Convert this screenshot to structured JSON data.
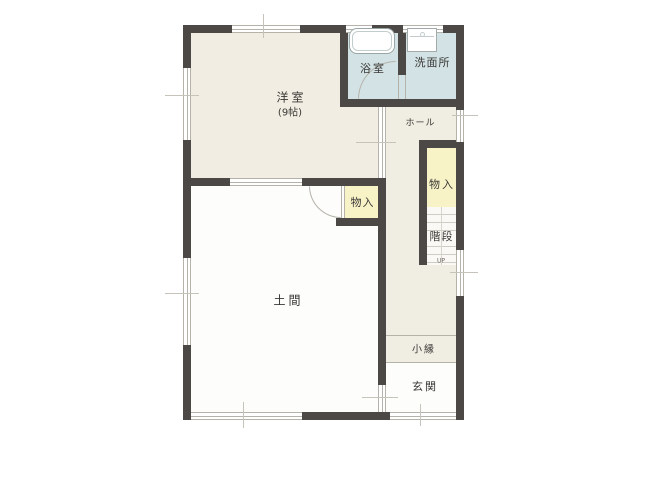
{
  "page_title": "間取り図（1階平面図）",
  "colors": {
    "wall": "#4b4846",
    "beige": "#f1ede2",
    "blue": "#d3e3e5",
    "cream": "#f0ede2",
    "yellow": "#f8f3c7",
    "white": "#fdfdfc",
    "line": "#b5b2aa",
    "tick": "#c6c3ba",
    "text": "#3a3836"
  },
  "rooms": {
    "western_room": {
      "label": "洋室",
      "size": "(9帖)"
    },
    "bathroom": {
      "label": "浴室"
    },
    "washroom": {
      "label": "洗面所"
    },
    "hall": {
      "label": "ホール"
    },
    "closet_hall": {
      "label": "物入"
    },
    "stairs": {
      "label": "階段",
      "direction": "UP"
    },
    "closet_doma": {
      "label": "物入"
    },
    "doma": {
      "label": "土間"
    },
    "veranda": {
      "label": "小縁"
    },
    "entrance": {
      "label": "玄関"
    }
  }
}
